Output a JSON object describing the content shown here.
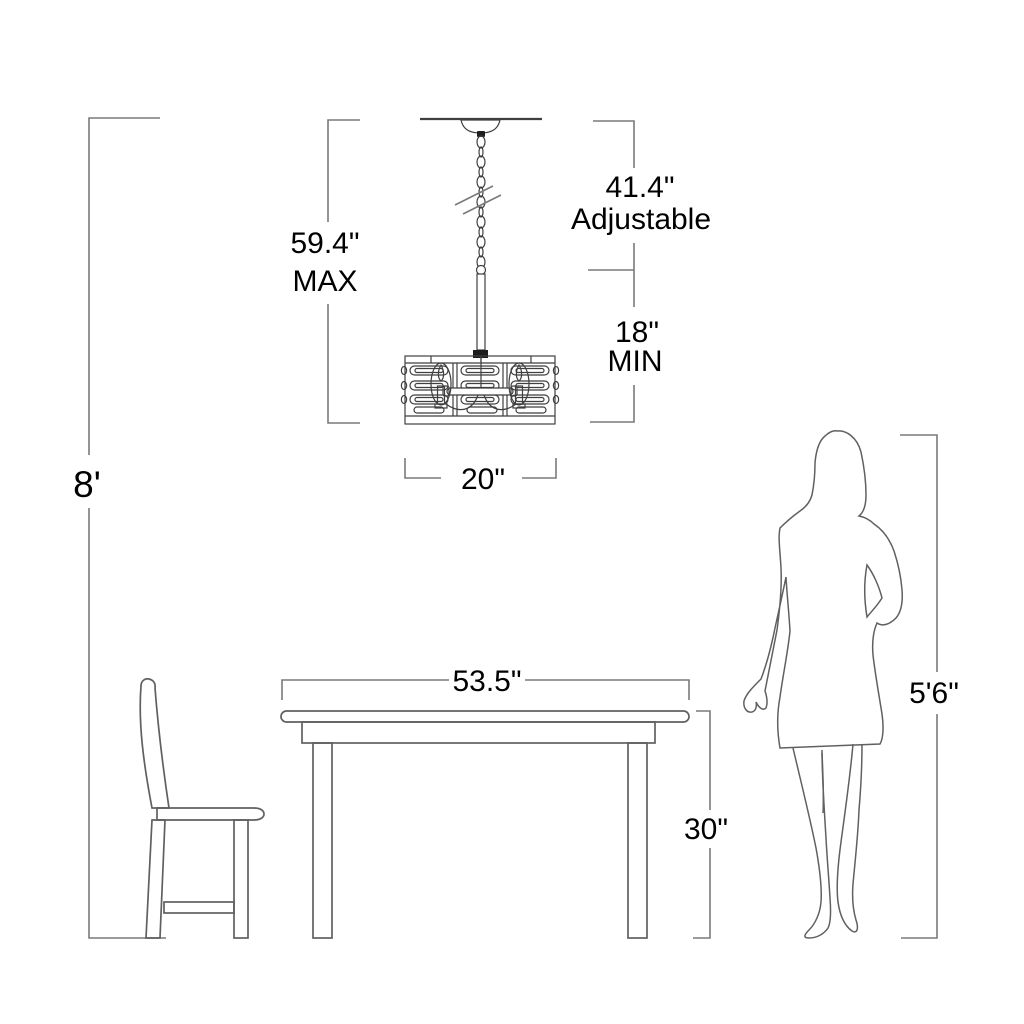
{
  "figure": {
    "type": "product-dimension-diagram",
    "background": "#ffffff",
    "dimension_line_color": "#7a7a7a",
    "drawing_line_color": "#606060",
    "fixture_line_color": "#3f3f3f",
    "text_color": "#000000"
  },
  "labels": {
    "ceiling_height": "8'",
    "max_value": "59.4\"",
    "max_word": "MAX",
    "adjustable_value": "41.4\"",
    "adjustable_word": "Adjustable",
    "min_value": "18\"",
    "min_word": "MIN",
    "fixture_width": "20\"",
    "table_width": "53.5\"",
    "table_height": "30\"",
    "person_height": "5'6\""
  },
  "figures": {
    "chandelier": "pendant-chandelier",
    "table": "dining-table",
    "chair": "dining-chair",
    "person": "woman-silhouette"
  }
}
